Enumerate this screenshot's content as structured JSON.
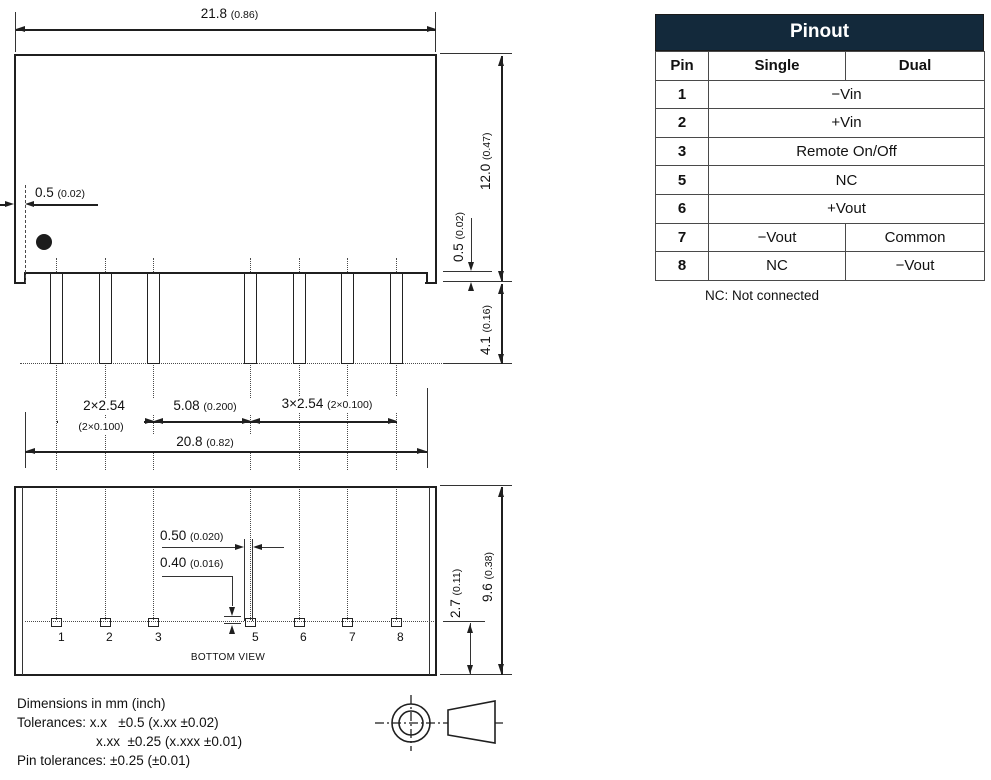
{
  "pinout_table": {
    "title": "Pinout",
    "col_pin": "Pin",
    "col_single": "Single",
    "col_dual": "Dual",
    "rows": [
      {
        "pin": "1",
        "single": "−Vin"
      },
      {
        "pin": "2",
        "single": "+Vin"
      },
      {
        "pin": "3",
        "single": "Remote On/Off"
      },
      {
        "pin": "5",
        "single": "NC"
      },
      {
        "pin": "6",
        "single": "+Vout"
      },
      {
        "pin": "7",
        "single": "−Vout",
        "dual": "Common"
      },
      {
        "pin": "8",
        "single": "NC",
        "dual": "−Vout"
      }
    ],
    "note": "NC: Not connected"
  },
  "dims": {
    "body_width_mm": "21.8",
    "body_width_in": "(0.86)",
    "edge_inset_mm": "0.5",
    "edge_inset_in": "(0.02)",
    "body_height_mm": "12.0",
    "body_height_in": "(0.47)",
    "standoff_mm": "0.5",
    "standoff_in": "(0.02)",
    "pin_length_mm": "4.1",
    "pin_length_in": "(0.16)",
    "pitch_left_mm": "2×2.54",
    "pitch_left_in": "(2×0.100)",
    "pitch_mid_mm": "5.08",
    "pitch_mid_in": "(0.200)",
    "pitch_right_mm": "3×2.54",
    "pitch_right_in": "(2×0.100)",
    "pin_span_mm": "20.8",
    "pin_span_in": "(0.82)",
    "pin_width_mm": "0.50",
    "pin_width_in": "(0.020)",
    "pin_thickness_mm": "0.40",
    "pin_thickness_in": "(0.016)",
    "pin_row_offset_mm": "2.7",
    "pin_row_offset_in": "(0.11)",
    "body_depth_mm": "9.6",
    "body_depth_in": "(0.38)"
  },
  "pins": [
    "1",
    "2",
    "3",
    "5",
    "6",
    "7",
    "8"
  ],
  "labels": {
    "bottom_view": "BOTTOM VIEW"
  },
  "notes": {
    "line1": "Dimensions in mm (inch)",
    "line2": "Tolerances: x.x   ±0.5 (x.xx ±0.02)",
    "line3": "x.xx  ±0.25 (x.xxx ±0.01)",
    "line4": "Pin tolerances: ±0.25 (±0.01)"
  },
  "colors": {
    "table_header_bg": "#13293b",
    "table_header_text": "#ffffff",
    "line_color": "#1f1f1f"
  }
}
